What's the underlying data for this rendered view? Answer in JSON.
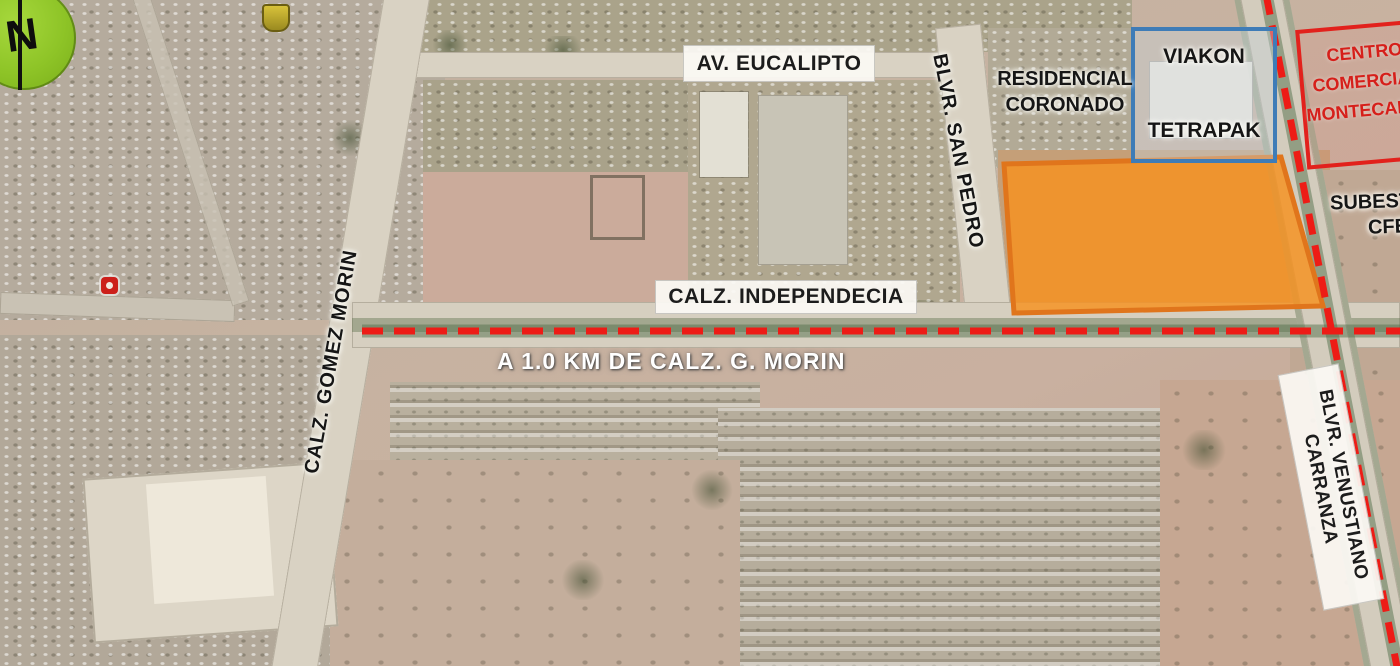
{
  "map": {
    "type": "annotated-satellite-location-map",
    "labels": {
      "north": "N",
      "av_eucalipto": "AV. EUCALIPTO",
      "residencial_coronado": [
        "RESIDENCIAL",
        "CORONADO"
      ],
      "viakon": "VIAKON",
      "tetrapak": "TETRAPAK",
      "centro_comercial": [
        "CENTRO",
        "COMERCIAL",
        "MONTECARLO"
      ],
      "blvr_san_pedro": "BLVR. SAN PEDRO",
      "subestacion": [
        "SUBESTACION",
        "CFE"
      ],
      "calz_independecia": "CALZ. INDEPENDECIA",
      "calz_gomez_morin": "CALZ. GOMEZ MORIN",
      "distance_note": "A 1.0 KM DE CALZ. G. MORIN",
      "blvr_venustiano_carranza": [
        "BLVR. VENUSTIANO",
        "CARRANZA"
      ]
    },
    "colors": {
      "property_fill": "#F6911E",
      "property_border": "#E0751C",
      "dashed_route": "#ED1C16",
      "viakon_box_border": "#3E7CB7",
      "centro_box_border": "#E2211C",
      "centro_text": "#D61F1A",
      "north_badge": "#8EC427",
      "distance_text": "#FFFFFF"
    }
  }
}
